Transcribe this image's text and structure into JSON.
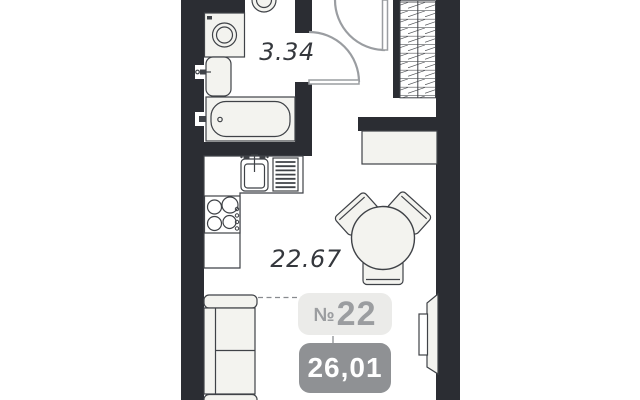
{
  "unit": {
    "number_prefix": "№",
    "number": "22",
    "area_value": "26,01"
  },
  "rooms": {
    "bathroom": {
      "name": "bathroom",
      "area_label": "3.34"
    },
    "main": {
      "name": "living-kitchen-room",
      "area_label": "22.67"
    }
  },
  "colors": {
    "wall": "#2b2d33",
    "outline": "#3f4247",
    "fixture_fill": "#f3f3ef",
    "door": "#9a9da1",
    "hatch": "#54565a",
    "dashed_line": "#888b8f",
    "label_text": "#35383d",
    "badge_number_bg": "#ebebe9",
    "badge_number_text": "#9b9da0",
    "badge_area_bg": "#8f9194",
    "badge_area_text": "#ffffff"
  },
  "fixtures": [
    "toilet",
    "washing-machine",
    "bathroom-sink",
    "bathtub",
    "kitchen-sink",
    "dish-rack",
    "stove",
    "kitchen-counter",
    "wardrobe",
    "console-table",
    "dining-table",
    "chair",
    "sofa",
    "radiator-panel"
  ]
}
